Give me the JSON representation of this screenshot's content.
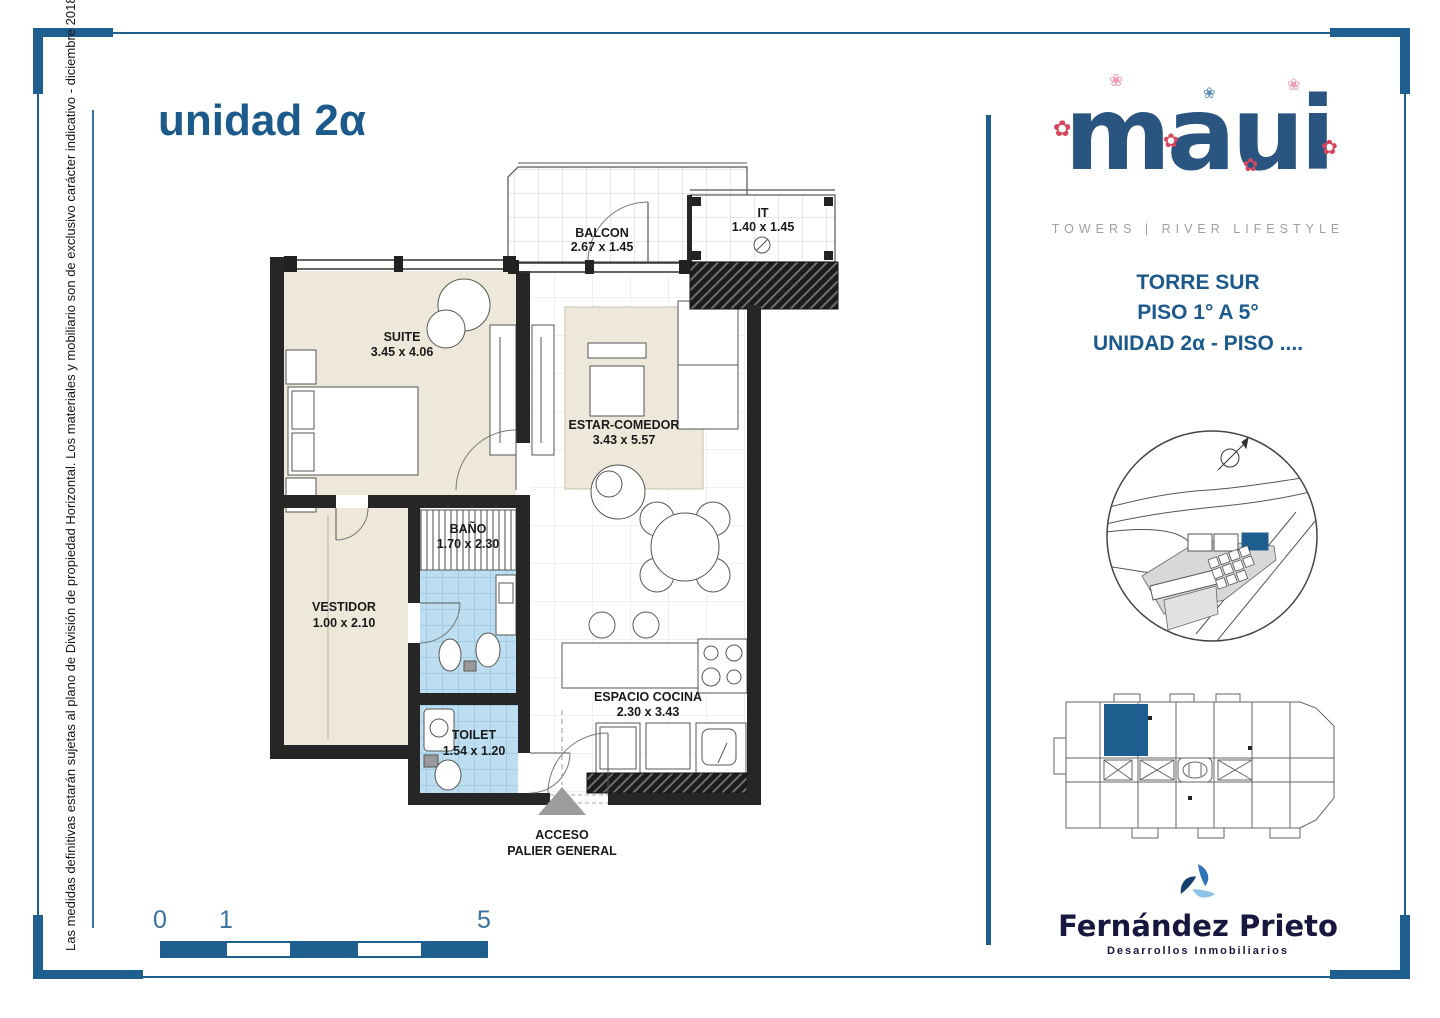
{
  "page": {
    "title": "unidad 2α",
    "sidebar_note": "Las medidas definitivas estarán sujetas al plano de División de propiedad Horizontal. Los materiales y mobiliario son de exclusivo carácter indicativo - diciembre 2018"
  },
  "plan": {
    "rooms": [
      {
        "name": "BALCON",
        "dims": "2.67 x 1.45"
      },
      {
        "name": "IT",
        "dims": "1.40 x 1.45"
      },
      {
        "name": "SUITE",
        "dims": "3.45 x 4.06"
      },
      {
        "name": "ESTAR-COMEDOR",
        "dims": "3.43 x 5.57"
      },
      {
        "name": "VESTIDOR",
        "dims": "1.00 x 2.10"
      },
      {
        "name": "BAÑO",
        "dims": "1.70 x 2.30"
      },
      {
        "name": "TOILET",
        "dims": "1.54 x 1.20"
      },
      {
        "name": "ESPACIO COCINA",
        "dims": "2.30 x 3.43"
      }
    ],
    "access": {
      "line1": "ACCESO",
      "line2": "PALIER GENERAL"
    }
  },
  "scale_bar": {
    "start": "0",
    "mid": "1",
    "end": "5"
  },
  "brand": {
    "logo": "maui",
    "tagline": "TOWERS | RIVER LIFESTYLE",
    "tower": "TORRE SUR",
    "floors": "PISO 1° A 5°",
    "unit": "UNIDAD 2α - PISO ....",
    "developer": "Fernández Prieto",
    "developer_tagline": "Desarrollos Inmobiliarios"
  },
  "colors": {
    "accent_blue": "#1f5f8f",
    "title_blue": "#1c5a8c",
    "room_cream": "#ede8d9",
    "bath_tile": "#bcdef0",
    "unit_highlight": "#1f5f8f"
  }
}
